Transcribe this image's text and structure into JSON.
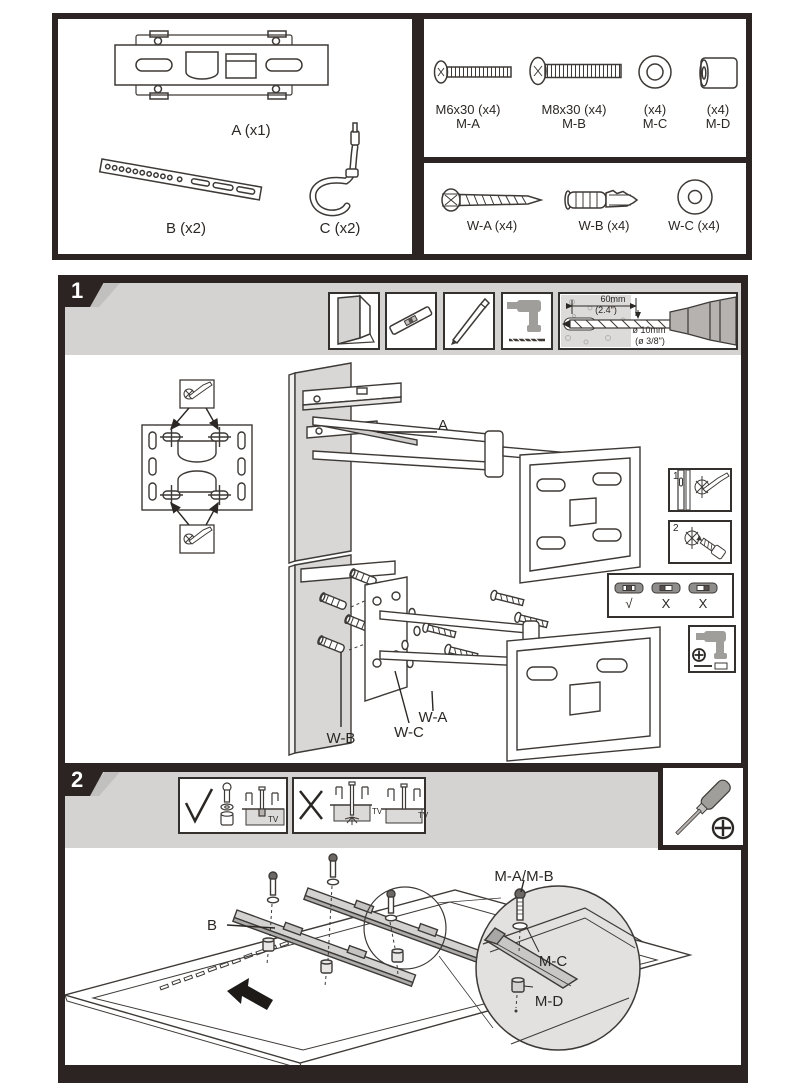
{
  "colors": {
    "frame": "#2b2422",
    "band": "#d5d3d2",
    "wall_gray": "#d9d7d5"
  },
  "parts_box": {
    "a_label": "A (x1)",
    "b_label": "B (x2)",
    "c_label": "C (x2)"
  },
  "hardware_box": {
    "m_a_size": "M6x30 (x4)",
    "m_a_code": "M-A",
    "m_b_size": "M8x30 (x4)",
    "m_b_code": "M-B",
    "m_c_qty": "(x4)",
    "m_c_code": "M-C",
    "m_d_qty": "(x4)",
    "m_d_code": "M-D",
    "w_a_label": "W-A (x4)",
    "w_b_label": "W-B (x4)",
    "w_c_label": "W-C (x4)"
  },
  "step1": {
    "number": "1",
    "drill_depth_mm": "60mm",
    "drill_depth_in": "(2.4\")",
    "drill_dia_mm": "ø 10mm",
    "drill_dia_in": "(ø 3/8\")",
    "label_arm": "A",
    "label_lag": "W-A",
    "label_anchor": "W-B",
    "label_washer": "W-C",
    "inset_mark": "1",
    "inset_drill": "2",
    "level_ok": "√",
    "level_bad_left": "X",
    "level_bad_right": "X"
  },
  "step2": {
    "number": "2",
    "tv": "TV",
    "label_rail": "B",
    "label_screw": "M-A/M-B",
    "label_washer": "M-C",
    "label_spacer": "M-D"
  }
}
